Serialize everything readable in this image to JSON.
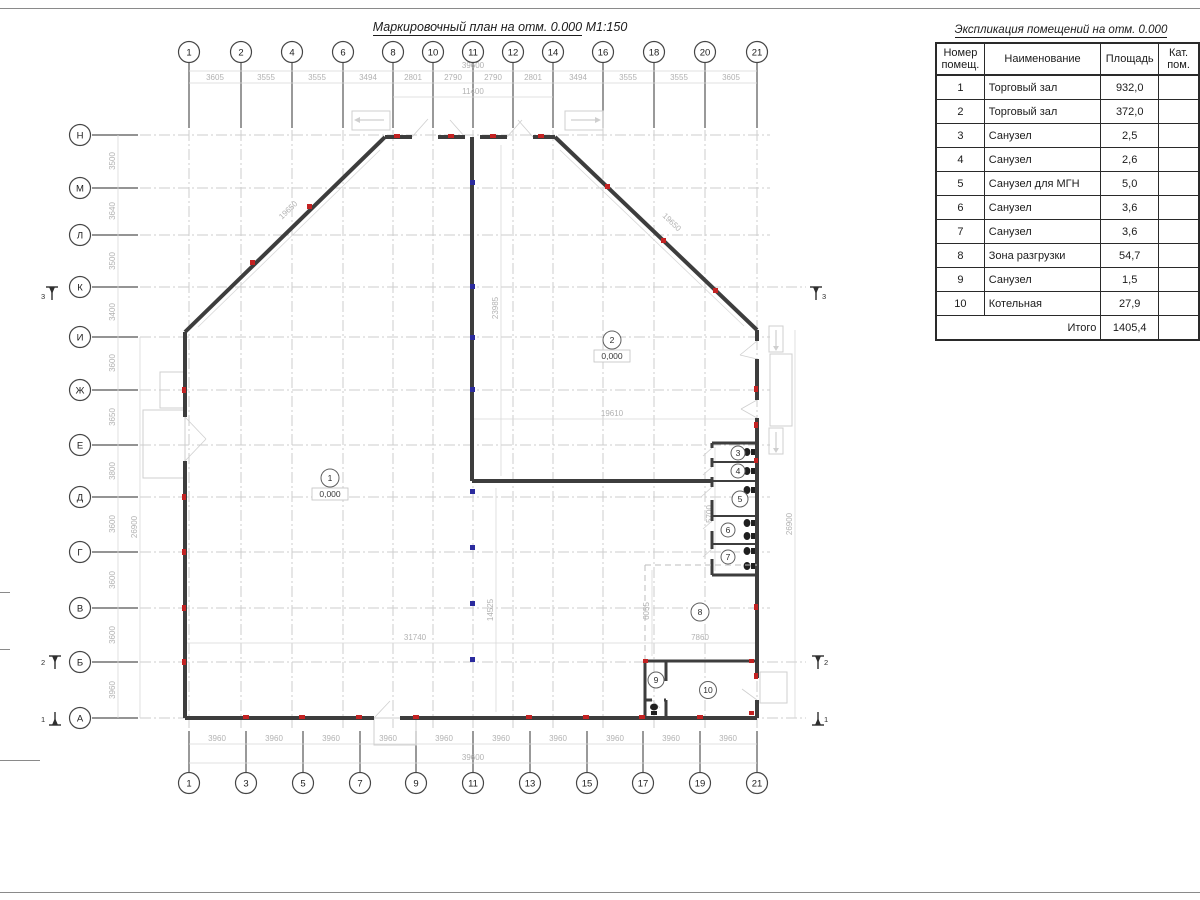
{
  "plan": {
    "title_main": "Маркировочный план на отм. 0.000",
    "title_scale": "М1:150",
    "rooms": {
      "r1": "1",
      "r1_elev": "0,000",
      "r2": "2",
      "r2_elev": "0,000",
      "r3": "3",
      "r4": "4",
      "r5": "5",
      "r6": "6",
      "r7": "7",
      "r8": "8",
      "r9": "9",
      "r10": "10"
    }
  },
  "axes": {
    "top": [
      "1",
      "2",
      "4",
      "6",
      "8",
      "10",
      "11",
      "12",
      "14",
      "16",
      "18",
      "20",
      "21"
    ],
    "bottom": [
      "1",
      "3",
      "5",
      "7",
      "9",
      "11",
      "13",
      "15",
      "17",
      "19",
      "21"
    ],
    "left": [
      "Н",
      "М",
      "Л",
      "К",
      "И",
      "Ж",
      "Е",
      "Д",
      "Г",
      "В",
      "Б",
      "А"
    ]
  },
  "dims": {
    "top_overall": "39600",
    "top_segments": [
      "3605",
      "3555",
      "3555",
      "3494",
      "2801",
      "2790",
      "2790",
      "2801",
      "3494",
      "3555",
      "3555",
      "3605"
    ],
    "top_inner": "11400",
    "bottom_segments": [
      "3960",
      "3960",
      "3960",
      "3960",
      "3960",
      "3960",
      "3960",
      "3960",
      "3960",
      "3960"
    ],
    "bottom_overall": "39600",
    "left_segments": [
      "3500",
      "3640",
      "3500",
      "3400",
      "3600",
      "3650",
      "3800",
      "3600",
      "3600",
      "3600",
      "3960"
    ],
    "left_overall": "26900",
    "right_overall": "26900",
    "hall_width": "31740",
    "zone8_width": "7860",
    "room2_width": "19610",
    "wall_len": "23985",
    "hall_height": "14525",
    "zone8_height": "6055",
    "san_height": "5700",
    "diag_left": "19650",
    "diag_right": "19650"
  },
  "sections": {
    "s1": "1",
    "s2": "2",
    "s3": "3"
  },
  "table": {
    "title": "Экспликация помещений на отм. 0.000",
    "col_num": "Номер помещ.",
    "col_name": "Наименование",
    "col_area": "Площадь",
    "col_cat": "Кат. пом.",
    "rows": [
      {
        "num": "1",
        "name": "Торговый зал",
        "area": "932,0"
      },
      {
        "num": "2",
        "name": "Торговый зал",
        "area": "372,0"
      },
      {
        "num": "3",
        "name": "Санузел",
        "area": "2,5"
      },
      {
        "num": "4",
        "name": "Санузел",
        "area": "2,6"
      },
      {
        "num": "5",
        "name": "Санузел для МГН",
        "area": "5,0"
      },
      {
        "num": "6",
        "name": "Санузел",
        "area": "3,6"
      },
      {
        "num": "7",
        "name": "Санузел",
        "area": "3,6"
      },
      {
        "num": "8",
        "name": "Зона разгрузки",
        "area": "54,7"
      },
      {
        "num": "9",
        "name": "Санузел",
        "area": "1,5"
      },
      {
        "num": "10",
        "name": "Котельная",
        "area": "27,9"
      }
    ],
    "total_label": "Итого",
    "total_value": "1405,4"
  },
  "colors": {
    "wall": "#3d3d3d",
    "marker_red": "#c32222",
    "column_blue": "#2b2b9e",
    "grid": "#cdcdcd"
  }
}
